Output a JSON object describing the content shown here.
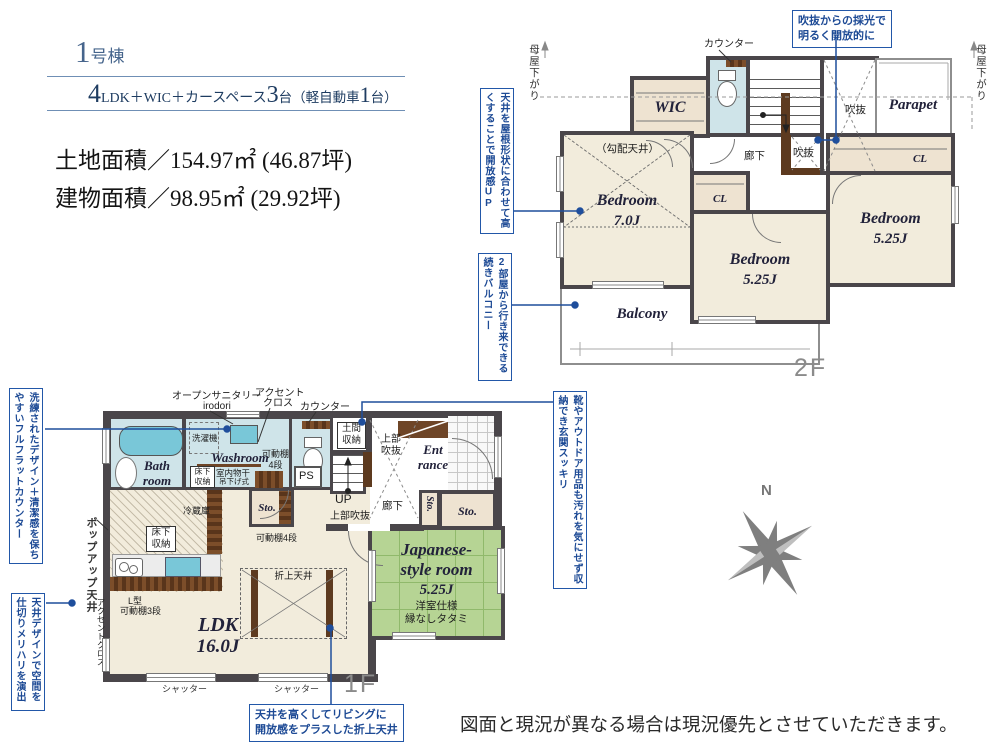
{
  "header": {
    "bno_num": "1",
    "bno_suf": "号棟",
    "s1": "4",
    "s2": "LDK＋WIC＋カースペース",
    "s3": "3",
    "s4": "台（軽自動車",
    "s5": "1",
    "s6": "台）",
    "land": "土地面積／154.97㎡ (46.87坪)",
    "bldg": "建物面積／98.95㎡ (29.92坪)"
  },
  "f2": {
    "fl": "2F",
    "moya_l": "母屋下がり",
    "moya_r": "母屋下がり",
    "counter": "カウンター",
    "co_light1": "吹抜からの採光で",
    "co_light2": "明るく開放的に",
    "co_ceiling": "天井を屋根形状に合わせて高くすることで開放感UP",
    "co_balcony": "2部屋から行き来できる続きバルコニー",
    "wic": "WIC",
    "dn": "DN",
    "parapet": "Parapet",
    "void1": "吹抜",
    "void2": "吹抜",
    "corridor": "廊下",
    "slope": "（勾配天井）",
    "br1n": "Bedroom",
    "br1s": "7.0J",
    "clm": "CL",
    "clr": "CL",
    "br2n": "Bedroom",
    "br2s": "5.25J",
    "br3n": "Bedroom",
    "br3s": "5.25J",
    "balcony": "Balcony"
  },
  "f1": {
    "fl": "1F",
    "co_counter": "洗練されたデザイン＋清潔感を保ちやすいフルフラットカウンター",
    "popup": "ポップアップ天井",
    "co_design": "天井デザインで空間を仕切りメリハリを演出",
    "co_genkan": "靴やアウトドア用品も汚れを気にせず収納でき玄関スッキリ",
    "co_fold1": "天井を高くしてリビングに",
    "co_fold2": "開放感をプラスした折上天井",
    "opensan1": "オープンサニタリー",
    "opensan2": "irodori",
    "accent1": "アクセント",
    "accent2": "クロス",
    "counter": "カウンター",
    "washer": "洗濯機",
    "bath1": "Bath",
    "bath2": "room",
    "washroom": "Washroom",
    "yuka1a": "床下",
    "yuka1b": "収納",
    "mono1": "室内物干",
    "mono2": "吊下げ式",
    "kadou1a": "可動棚",
    "kadou1b": "4段",
    "ps": "PS",
    "doma1": "土間",
    "doma2": "収納",
    "jofuki1a": "上部",
    "jofuki1b": "吹抜",
    "ent1": "Ent",
    "ent2": "rance",
    "up": "UP",
    "corridor": "廊下",
    "jofuki2": "上部吹抜",
    "sto1": "Sto.",
    "sto2": "Sto.",
    "sto3": "Sto.",
    "kadou2": "可動棚4段",
    "fridge": "冷蔵庫",
    "yuka2a": "床下",
    "yuka2b": "収納",
    "lgata1": "L型",
    "lgata2": "可動棚3段",
    "accent_side": "アクセントクロス",
    "oriage": "折上天井",
    "ldk": "LDK",
    "ldks": "16.0J",
    "jp1": "Japanese-",
    "jp2": "style room",
    "jp3": "5.25J",
    "jp4": "洋室仕様",
    "jp5": "縁なしタタミ",
    "shutter1": "シャッター",
    "shutter2": "シャッター"
  },
  "misc": {
    "north": "N",
    "disclaimer": "図面と現況が異なる場合は現況優先とさせていただきます。"
  },
  "colors": {
    "annotation_blue": "#2257a8",
    "wall_gray": "#4a464a",
    "room_cream": "#f2ecdc",
    "closet_tan": "#eee3d1",
    "water_blue": "#cfe4e9",
    "tatami_green": "#b6d494",
    "counter_brown": "#6e4527",
    "fixture_blue": "#79c7d8"
  }
}
